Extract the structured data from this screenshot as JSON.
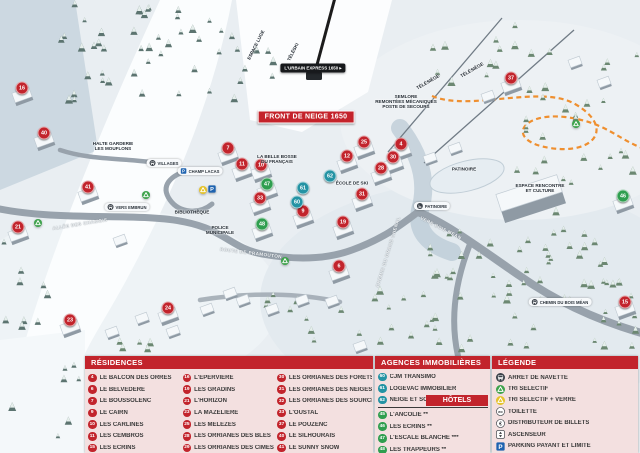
{
  "colors": {
    "residence": "#c2242c",
    "agence": "#2493a4",
    "hotel": "#2f9e4f",
    "header": "#c2242c",
    "panel_bg": "#f3e0e0"
  },
  "map": {
    "banner": "FRONT DE NEIGE 1650",
    "lift_badge": "L'URBAIN EXPRESS 1650 ▸",
    "labels": [
      {
        "text": "SEMLORE\nREMONTÉES MÉCANIQUES\nPOSTE DE SECOURS",
        "x": 406,
        "y": 102,
        "type": "dark"
      },
      {
        "text": "ESPACE RENCONTRE\nET CULTURE",
        "x": 540,
        "y": 188,
        "type": "dark"
      },
      {
        "text": "HALTE GARDERIE\nLES MOUFLONS",
        "x": 113,
        "y": 146,
        "type": "dark"
      },
      {
        "text": "LA BELLE BOSSE\nDU FRANÇAIS",
        "x": 277,
        "y": 159,
        "type": "dark"
      },
      {
        "text": "ÉCOLE DE SKI",
        "x": 352,
        "y": 183,
        "type": "dark"
      },
      {
        "text": "BIBLIOTHÈQUE",
        "x": 192,
        "y": 212,
        "type": "dark"
      },
      {
        "text": "POLICE\nMUNICIPALE",
        "x": 220,
        "y": 230,
        "type": "dark"
      },
      {
        "text": "PATINOIRE",
        "x": 464,
        "y": 169,
        "type": "dark"
      },
      {
        "text": "ESPACE LUGE",
        "x": 256,
        "y": 45,
        "type": "dark",
        "rotate": -63
      },
      {
        "text": "TÉLÉSKI",
        "x": 293,
        "y": 52,
        "type": "dark",
        "rotate": -63
      },
      {
        "text": "TÉLÉSIÈGE",
        "x": 428,
        "y": 82,
        "type": "dark",
        "rotate": -30
      },
      {
        "text": "TÉLÉSIÈGE",
        "x": 472,
        "y": 70,
        "type": "dark",
        "rotate": -30
      },
      {
        "text": "VILLAGES",
        "x": 164,
        "y": 163,
        "type": "pill",
        "icon": "bus-icon"
      },
      {
        "text": "CHAMP LACAS",
        "x": 200,
        "y": 171,
        "type": "pill",
        "icon": "parking-icon"
      },
      {
        "text": "PATINOIRE",
        "x": 432,
        "y": 206,
        "type": "pill",
        "icon": "skate-icon"
      },
      {
        "text": "VERS EMBRUN",
        "x": 127,
        "y": 207,
        "type": "pill",
        "icon": "bus-icon"
      },
      {
        "text": "CHEMIN DU BOIS MÉAN",
        "x": 560,
        "y": 302,
        "type": "pill",
        "icon": "bus-icon"
      },
      {
        "text": "ROUTE DE PRAMOUTON",
        "x": 251,
        "y": 253,
        "type": "road",
        "rotate": 7
      },
      {
        "text": "ALLÉE DES CHAMOIS",
        "x": 80,
        "y": 224,
        "type": "road",
        "rotate": -9
      },
      {
        "text": "VERS BOIS MÉAN",
        "x": 441,
        "y": 228,
        "type": "road",
        "rotate": 27
      },
      {
        "text": "CHEMIN DU GRAND CHENAL",
        "x": 388,
        "y": 252,
        "type": "road",
        "rotate": -73
      }
    ],
    "markers": [
      {
        "n": 16,
        "x": 22,
        "y": 88,
        "k": "residence"
      },
      {
        "n": 40,
        "x": 44,
        "y": 133,
        "k": "residence"
      },
      {
        "n": 41,
        "x": 88,
        "y": 187,
        "k": "residence"
      },
      {
        "n": 21,
        "x": 18,
        "y": 227,
        "k": "residence"
      },
      {
        "n": 23,
        "x": 70,
        "y": 320,
        "k": "residence"
      },
      {
        "n": 24,
        "x": 168,
        "y": 308,
        "k": "residence"
      },
      {
        "n": 7,
        "x": 228,
        "y": 148,
        "k": "residence"
      },
      {
        "n": 11,
        "x": 242,
        "y": 164,
        "k": "residence"
      },
      {
        "n": 10,
        "x": 261,
        "y": 165,
        "k": "residence"
      },
      {
        "n": 33,
        "x": 260,
        "y": 198,
        "k": "residence"
      },
      {
        "n": 9,
        "x": 303,
        "y": 211,
        "k": "residence"
      },
      {
        "n": 19,
        "x": 343,
        "y": 222,
        "k": "residence"
      },
      {
        "n": 6,
        "x": 339,
        "y": 266,
        "k": "residence"
      },
      {
        "n": 12,
        "x": 347,
        "y": 156,
        "k": "residence"
      },
      {
        "n": 25,
        "x": 364,
        "y": 142,
        "k": "residence"
      },
      {
        "n": 4,
        "x": 401,
        "y": 144,
        "k": "residence"
      },
      {
        "n": 30,
        "x": 393,
        "y": 157,
        "k": "residence"
      },
      {
        "n": 28,
        "x": 381,
        "y": 168,
        "k": "residence"
      },
      {
        "n": 31,
        "x": 362,
        "y": 194,
        "k": "residence"
      },
      {
        "n": 37,
        "x": 511,
        "y": 78,
        "k": "residence"
      },
      {
        "n": 15,
        "x": 625,
        "y": 302,
        "k": "residence"
      },
      {
        "n": 47,
        "x": 267,
        "y": 184,
        "k": "hotel"
      },
      {
        "n": 48,
        "x": 262,
        "y": 224,
        "k": "hotel"
      },
      {
        "n": 46,
        "x": 623,
        "y": 196,
        "k": "hotel"
      },
      {
        "n": 61,
        "x": 303,
        "y": 188,
        "k": "agence"
      },
      {
        "n": 60,
        "x": 297,
        "y": 202,
        "k": "agence"
      },
      {
        "n": 62,
        "x": 330,
        "y": 176,
        "k": "agence"
      }
    ],
    "map_icons": [
      {
        "type": "recycle-green-icon",
        "x": 146,
        "y": 195
      },
      {
        "type": "recycle-green-icon",
        "x": 38,
        "y": 223
      },
      {
        "type": "recycle-green-icon",
        "x": 285,
        "y": 261
      },
      {
        "type": "recycle-green-icon",
        "x": 576,
        "y": 124
      },
      {
        "type": "recycle-yellow-icon",
        "x": 203,
        "y": 190
      },
      {
        "type": "parking-icon",
        "x": 212,
        "y": 189
      }
    ]
  },
  "panels": {
    "residences": {
      "title": "RÉSIDENCES",
      "columns": [
        [
          {
            "n": 4,
            "name": "LE BALCON DES ORRES"
          },
          {
            "n": 6,
            "name": "LE BELVÉDÈRE"
          },
          {
            "n": 7,
            "name": "LE BOUSSOLENC"
          },
          {
            "n": 9,
            "name": "LE CAIRN"
          },
          {
            "n": 10,
            "name": "LES CARLINES"
          },
          {
            "n": 11,
            "name": "LES CEMBROS"
          },
          {
            "n": 15,
            "name": "LES ÉCRINS"
          }
        ],
        [
          {
            "n": 16,
            "name": "L'ÉPERVIÈRE"
          },
          {
            "n": 19,
            "name": "LES GRADINS"
          },
          {
            "n": 21,
            "name": "L'HORIZON"
          },
          {
            "n": 23,
            "name": "LA MAZELIÈRE"
          },
          {
            "n": 25,
            "name": "LES MÉLÈZES"
          },
          {
            "n": 28,
            "name": "LES ORRIANES DES BLÉS"
          },
          {
            "n": 29,
            "name": "LES ORRIANES DES CIMES"
          }
        ],
        [
          {
            "n": 30,
            "name": "LES ORRIANES DES FORÊTS"
          },
          {
            "n": 31,
            "name": "LES ORRIANES DES NEIGES"
          },
          {
            "n": 32,
            "name": "LES ORRIANES DES SOURCES"
          },
          {
            "n": 33,
            "name": "L'OUSTAL"
          },
          {
            "n": 37,
            "name": "LE POUZENC"
          },
          {
            "n": 40,
            "name": "LE SILHOURAÏS"
          },
          {
            "n": 41,
            "name": "LE SUNNY SNOW"
          }
        ]
      ]
    },
    "agences": {
      "title": "AGENCES IMMOBILIÈRES",
      "items": [
        {
          "n": 60,
          "name": "CJM TRANSIMO"
        },
        {
          "n": 61,
          "name": "LOGEVAC IMMOBILIER"
        },
        {
          "n": 62,
          "name": "NEIGE ET SOLEIL"
        }
      ]
    },
    "hotels": {
      "title": "HÔTELS",
      "items": [
        {
          "n": 45,
          "name": "L'ANCOLIE **"
        },
        {
          "n": 46,
          "name": "LES ECRINS **"
        },
        {
          "n": 47,
          "name": "L'ESCALE BLANCHE ***"
        },
        {
          "n": 48,
          "name": "LES TRAPPEURS **"
        }
      ]
    },
    "legende": {
      "title": "LÉGENDE",
      "items": [
        {
          "icon": "bus-icon",
          "name": "ARRET DE NAVETTE"
        },
        {
          "icon": "recycle-green-icon",
          "name": "TRI SELECTIF"
        },
        {
          "icon": "recycle-yellow-icon",
          "name": "TRI SELECTIF + VERRE"
        },
        {
          "icon": "wc-icon",
          "name": "TOILETTE"
        },
        {
          "icon": "euro-icon",
          "name": "DISTRIBUTEUR DE BILLETS"
        },
        {
          "icon": "elevator-icon",
          "name": "ASCENSEUR"
        },
        {
          "icon": "parking-icon",
          "name": "PARKING PAYANT ET LIMITÉ"
        }
      ]
    }
  }
}
